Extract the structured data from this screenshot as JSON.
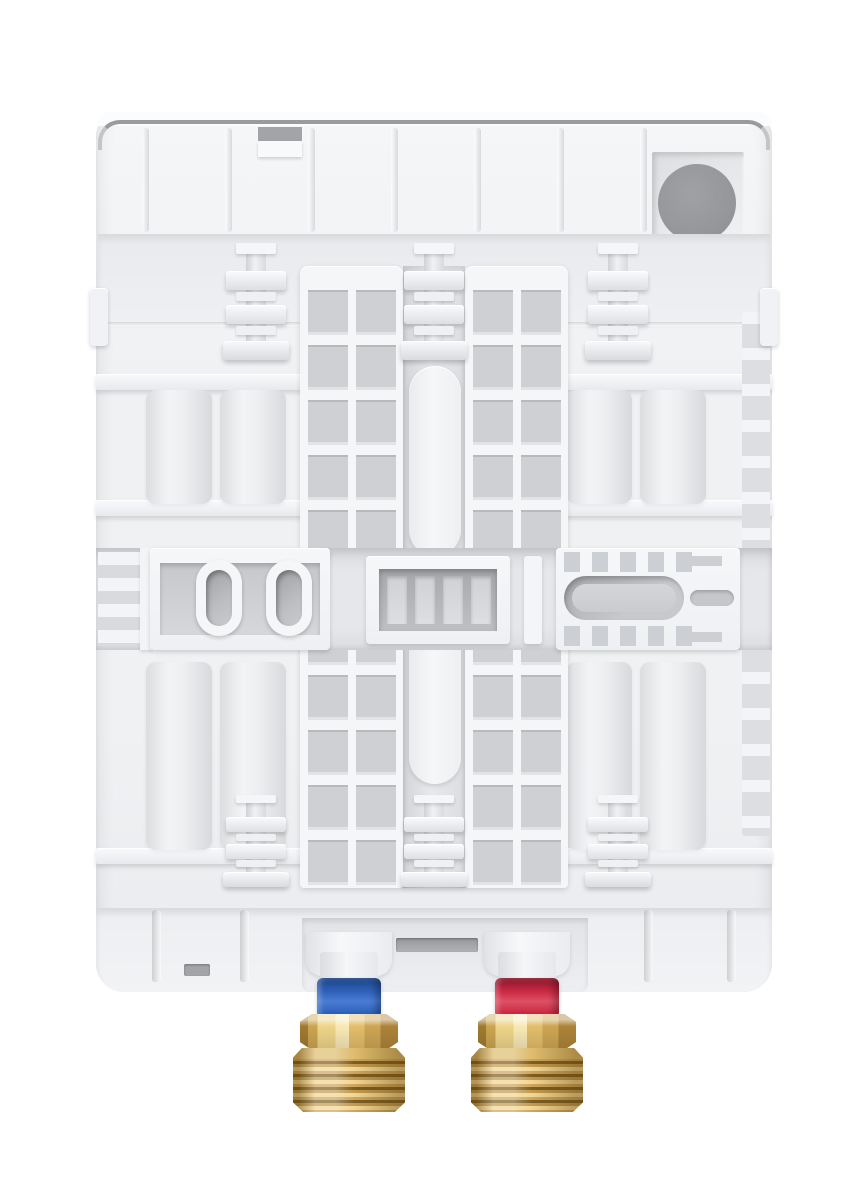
{
  "meta": {
    "type": "product-photo",
    "subject": "Rear view of a white tankless electric water heater back panel with molded mounting ribs, ladder-style rib grids, a round cable entry hole in the top-right recess, and two brass pipe fittings at the bottom: blue-ringed cold water inlet and red-ringed hot water outlet",
    "canvas": {
      "width": 867,
      "height": 1200
    }
  },
  "colors": {
    "housing_hi": "#f5f6f8",
    "housing": "#eff1f3",
    "housing_lo": "#e9ebee",
    "raised": "#f5f6f8",
    "raised_hi": "#fbfcfd",
    "recess": "#e4e6e9",
    "recess_dark": "#d6d8dc",
    "hole": "#cbcdd1",
    "hole_dark": "#a9abaf",
    "line": "#999b9f",
    "slot_gray": "#a2a4a8",
    "cable": "#95969a",
    "cold": "#2e61ba",
    "cold_dark": "#26509c",
    "cold_light": "#4a7cd2",
    "hot": "#cb2942",
    "hot_dark": "#a21f35",
    "hot_light": "#dc5166",
    "brass_light": "#eed488",
    "brass": "#d2a955",
    "brass_deep": "#b68c3c",
    "brass_dark": "#7c5c20"
  },
  "parts": {
    "housing": {
      "name": "back-panel-housing"
    },
    "cable_hole": {
      "name": "cable-entry-hole"
    },
    "top_ribs": {
      "count": 7
    },
    "mounting_clips": {
      "count_top": 3,
      "count_bottom": 3
    },
    "oval_holes": {
      "count": 2
    },
    "bracket_slots": {
      "count": 4
    },
    "fittings": [
      {
        "id": "cold",
        "name": "cold-water-inlet-fitting",
        "ring_color": "#2e61ba",
        "material": "brass"
      },
      {
        "id": "hot",
        "name": "hot-water-outlet-fitting",
        "ring_color": "#cb2942",
        "material": "brass"
      }
    ]
  }
}
